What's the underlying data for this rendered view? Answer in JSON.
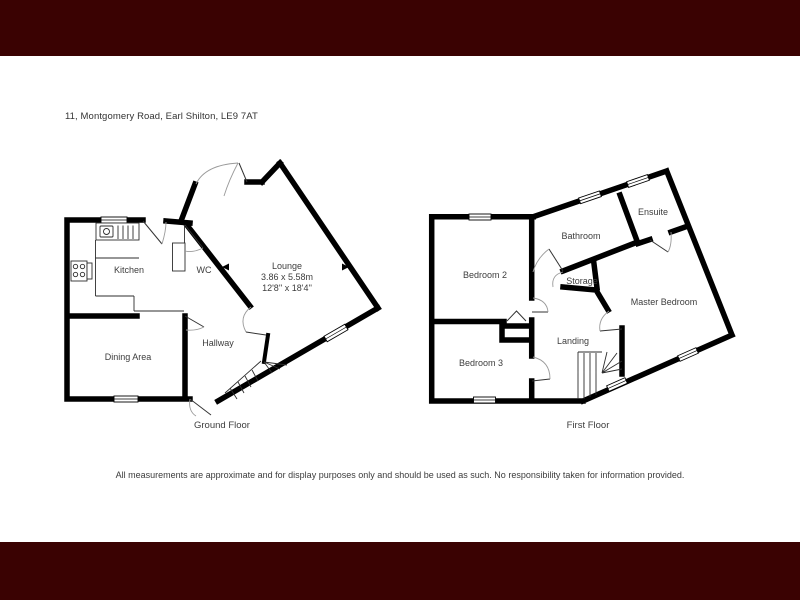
{
  "header": {
    "address": "11, Montgomery Road, Earl Shilton, LE9 7AT"
  },
  "ground_floor": {
    "caption": "Ground Floor",
    "rooms": {
      "kitchen": "Kitchen",
      "wc": "WC",
      "lounge": "Lounge",
      "lounge_dimensions_metric": "3.86 x 5.58m",
      "lounge_dimensions_imperial": "12'8'' x 18'4''",
      "dining": "Dining Area",
      "hallway": "Hallway"
    }
  },
  "first_floor": {
    "caption": "First Floor",
    "rooms": {
      "bedroom2": "Bedroom 2",
      "bathroom": "Bathroom",
      "ensuite": "Ensuite",
      "storage": "Storage",
      "master_bedroom": "Master Bedroom",
      "bedroom3": "Bedroom 3",
      "landing": "Landing"
    }
  },
  "footer": {
    "disclaimer": "All measurements are approximate and for display purposes only and should be used as such. No responsibility taken for information provided."
  },
  "colors": {
    "banner": "#3a0202",
    "walls": "#000000",
    "room_label": "#3d3d3d"
  }
}
